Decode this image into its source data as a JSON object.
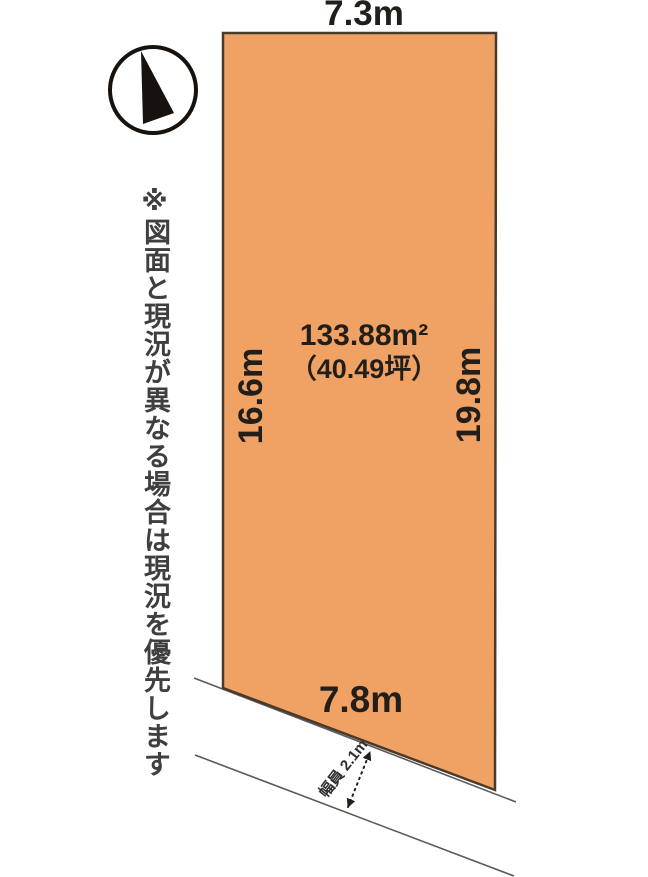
{
  "diagram": {
    "kind": "land-plot-site-plan",
    "disclaimer": "※図面と現況が異なる場合は現況を優先します",
    "plot": {
      "area_m2": "133.88m²",
      "area_tsubo": "（40.49坪）",
      "dimensions": {
        "top": "7.3m",
        "left": "16.6m",
        "right": "19.8m",
        "bottom": "7.8m"
      }
    },
    "road": {
      "width_label": "幅員 2.1m"
    },
    "compass": {
      "icon": "north-arrow"
    }
  },
  "colors": {
    "background": "#ffffff",
    "plot_fill": "#F0A264",
    "plot_border": "#4A3A2C",
    "road_line": "#5A5A5A",
    "dimension_text": "#221E1A",
    "disclaimer_text": "#3F3F3F",
    "road_label_text": "#2E2E2E",
    "compass_black": "#18120E"
  }
}
